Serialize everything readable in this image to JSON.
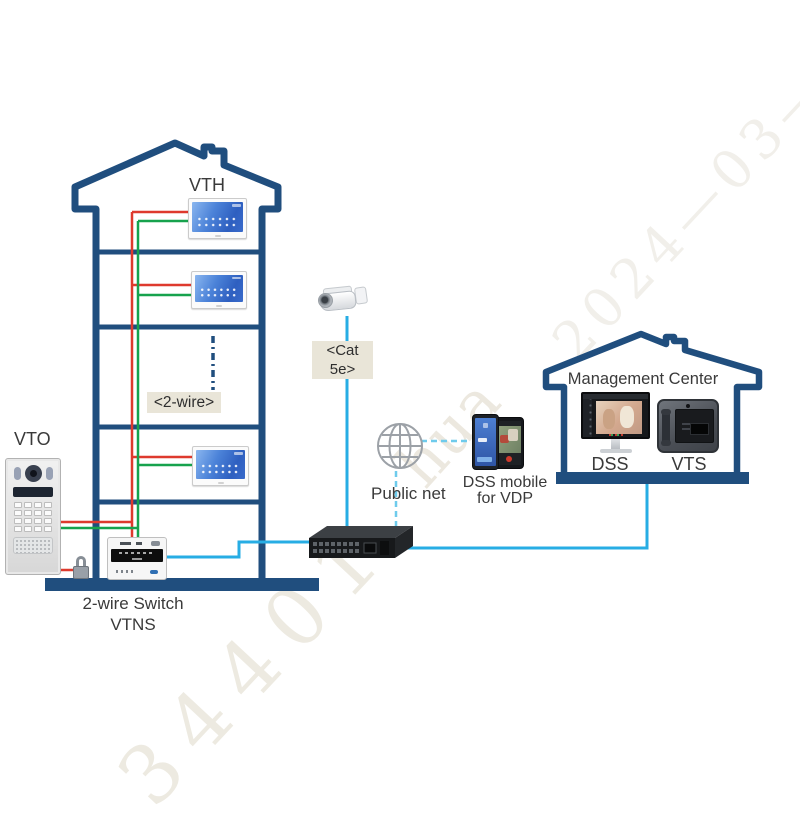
{
  "colors": {
    "outline_blue": "#204E7E",
    "wire_red": "#DE3A2E",
    "wire_green": "#17A24D",
    "ethernet_cyan": "#27ADE4",
    "internet_dashed_cyan": "#6FCBEC",
    "label_box_bg": "#E9E5D8",
    "label_text": "#3A3A3A",
    "watermark": "#ECE9E0"
  },
  "labels": {
    "vth": "VTH",
    "two_wire": "<2-wire>",
    "vto": "VTO",
    "vtns_line1": "2-wire Switch",
    "vtns_line2": "VTNS",
    "cat5e_line1": "<Cat",
    "cat5e_line2": "5e>",
    "public_net": "Public net",
    "dss_mobile_line1": "DSS mobile",
    "dss_mobile_line2": "for VDP",
    "management_center": "Management Center",
    "dss": "DSS",
    "vts": "VTS"
  },
  "watermarks": {
    "date": "2024—03—2",
    "brand_fragment": "hua",
    "number_fragment": "34401"
  },
  "topology": {
    "nodes": [
      {
        "id": "vth",
        "label": "VTH",
        "count": 3,
        "type": "indoor-monitor"
      },
      {
        "id": "vto",
        "label": "VTO",
        "type": "door-station"
      },
      {
        "id": "lock",
        "type": "door-lock"
      },
      {
        "id": "vtns",
        "label": "2-wire Switch VTNS",
        "type": "2-wire-switch"
      },
      {
        "id": "network-switch",
        "type": "ethernet-switch"
      },
      {
        "id": "camera",
        "type": "ip-camera"
      },
      {
        "id": "public-net",
        "label": "Public net",
        "type": "internet-cloud"
      },
      {
        "id": "dss-mobile",
        "label": "DSS mobile for VDP",
        "type": "smartphone-app"
      },
      {
        "id": "management-center",
        "label": "Management Center",
        "type": "site",
        "devices": [
          "DSS",
          "VTS"
        ]
      }
    ],
    "links": [
      {
        "from": "vto",
        "to": "vth",
        "medium": "<2-wire>"
      },
      {
        "from": "vto",
        "to": "lock",
        "medium": "wire"
      },
      {
        "from": "vto",
        "to": "vtns",
        "medium": "<2-wire>"
      },
      {
        "from": "vtns",
        "to": "network-switch",
        "medium": "ethernet"
      },
      {
        "from": "camera",
        "to": "network-switch",
        "medium": "<Cat 5e>"
      },
      {
        "from": "network-switch",
        "to": "management-center",
        "medium": "ethernet"
      },
      {
        "from": "public-net",
        "to": "network-switch",
        "medium": "internet"
      },
      {
        "from": "public-net",
        "to": "dss-mobile",
        "medium": "internet"
      }
    ]
  }
}
